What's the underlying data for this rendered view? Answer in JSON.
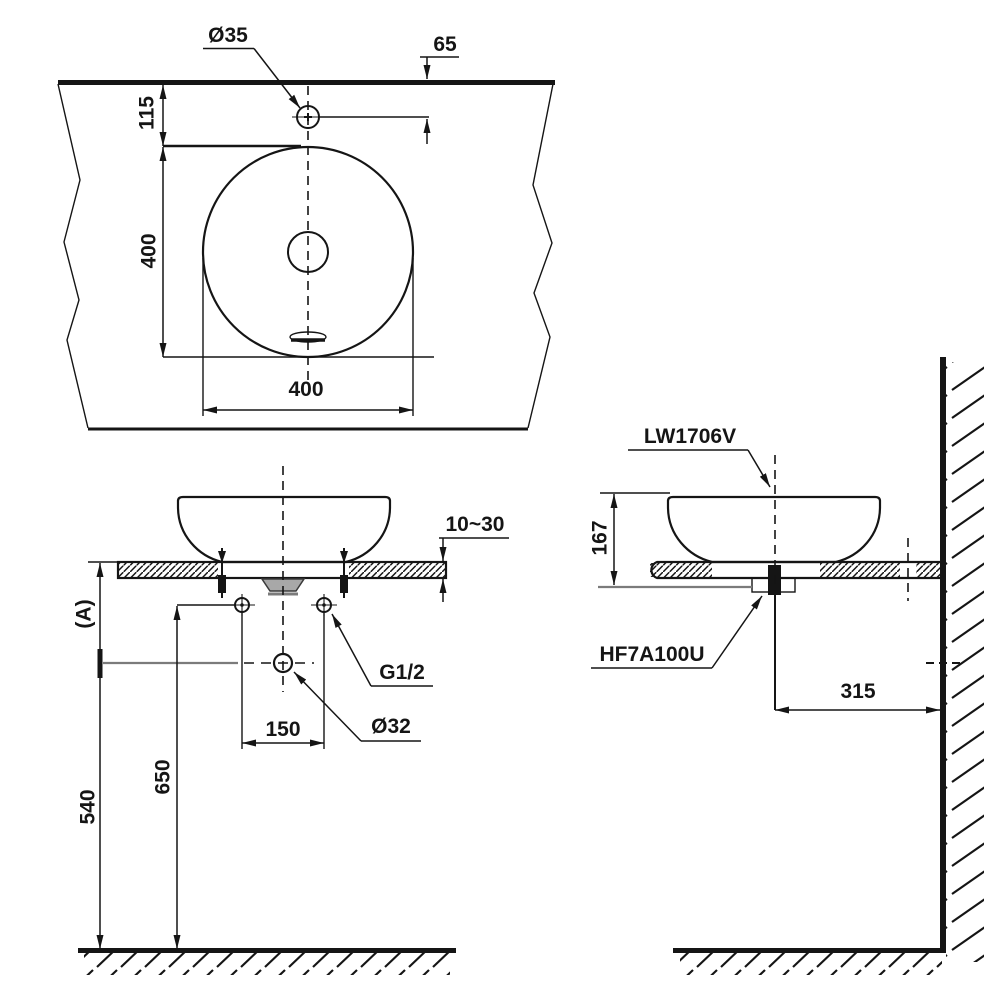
{
  "drawing": {
    "colors": {
      "line": "#151515",
      "gray": "#7b7b7b",
      "background": "#ffffff"
    },
    "top_view": {
      "faucet_hole_diameter": "Ø35",
      "hole_to_edge": "65",
      "edge_to_basin": "115",
      "basin_depth": "400",
      "basin_width": "400"
    },
    "front_view": {
      "counter_thickness": "10~30",
      "counter_height": "(A)",
      "supply_connection": "G1/2",
      "drain_diameter": "Ø32",
      "supply_hole_spacing": "150",
      "supply_height": "650",
      "drain_height": "540"
    },
    "side_view": {
      "basin_model": "LW1706V",
      "basin_height": "167",
      "drain_fitting_model": "HF7A100U",
      "center_to_wall": "315"
    }
  }
}
